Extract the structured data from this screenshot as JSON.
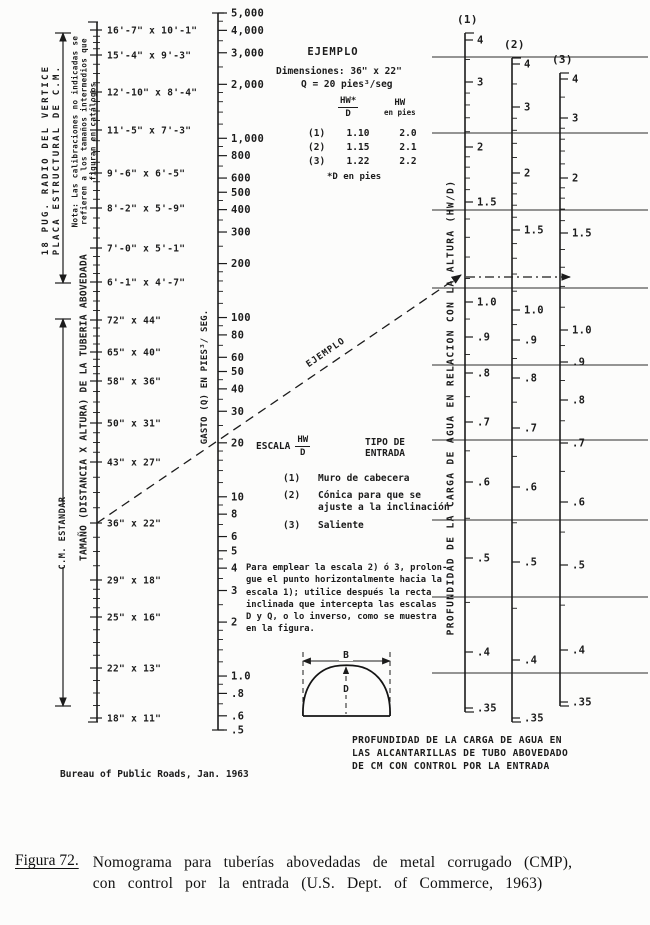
{
  "page": {
    "background": "#fcfcfb",
    "ink": "#1b1b1b"
  },
  "credit": "Bureau of Public Roads, Jan. 1963",
  "caption": {
    "figure_label": "Figura 72.",
    "text": "Nomograma para tuberías abovedadas de metal corrugado (CMP),\ncon control por la entrada (U.S. Dept. of Commerce, 1963)"
  },
  "chart_data": {
    "type": "nomograph",
    "title": "PROFUNDIDAD DE LA CARGA DE AGUA EN\nLAS ALCANTARILLAS DE TUBO ABOVEDADO\nDE CM CON CONTROL POR LA ENTRADA",
    "hw_axis_label": "PROFUNDIDAD DE LA CARGA DE AGUA EN RELACION CON LA ALTURA (HW/D)",
    "grid": {
      "x1": 432,
      "x2": 648,
      "ys": [
        57,
        133,
        210,
        288,
        365,
        440,
        520,
        597,
        673
      ]
    },
    "size_scale": {
      "label": "TAMAÑO (DISTANCIA X ALTURA) DE LA TUBERIA ABOVEDADA",
      "note": "Nota: Las calibraciones no indicadas se\nrefieren a los tamaños intermedios que\nfiguran en catálogos",
      "axis": {
        "x": 97,
        "top": 22,
        "bottom": 722
      },
      "groups": [
        {
          "label": "18 PUG. RADIO DEL VERTICE\nPLACA ESTRUCTURAL DE C.M."
        },
        {
          "label": "C.M. ESTANDAR"
        }
      ],
      "range_arrows": [
        {
          "x": 63,
          "y1": 33,
          "y2": 283,
          "start_arrow": true,
          "end_arrow": true,
          "bars": [
            33,
            283
          ]
        },
        {
          "x": 63,
          "y1": 319,
          "y2": 504,
          "start_arrow": true,
          "end_arrow": false,
          "bars": [
            319
          ]
        },
        {
          "x": 63,
          "y1": 567,
          "y2": 706,
          "start_arrow": false,
          "end_arrow": true,
          "bars": [
            706
          ]
        }
      ],
      "ticks": [
        {
          "label": "16'-7\" x 10'-1\"",
          "y": 30
        },
        {
          "label": "15'-4\" x 9'-3\"",
          "y": 55
        },
        {
          "label": "12'-10\" x 8'-4\"",
          "y": 92
        },
        {
          "label": "11'-5\" x 7'-3\"",
          "y": 130
        },
        {
          "label": "9'-6\" x 6'-5\"",
          "y": 173
        },
        {
          "label": "8'-2\" x 5'-9\"",
          "y": 208
        },
        {
          "label": "7'-0\" x 5'-1\"",
          "y": 248
        },
        {
          "label": "6'-1\" x 4'-7\"",
          "y": 282
        },
        {
          "label": "72\" x 44\"",
          "y": 320
        },
        {
          "label": "65\" x 40\"",
          "y": 352
        },
        {
          "label": "58\" x 36\"",
          "y": 381
        },
        {
          "label": "50\" x 31\"",
          "y": 423
        },
        {
          "label": "43\" x 27\"",
          "y": 462
        },
        {
          "label": "36\" x 22\"",
          "y": 523
        },
        {
          "label": "29\" x 18\"",
          "y": 580
        },
        {
          "label": "25\" x 16\"",
          "y": 617
        },
        {
          "label": "22\" x 13\"",
          "y": 668
        },
        {
          "label": "18\" x 11\"",
          "y": 718
        }
      ]
    },
    "q_scale": {
      "label": "GASTO (Q) EN PIES³/ SEG.",
      "axis": {
        "x": 218,
        "top": 13,
        "bottom": 730,
        "v_top": 5000,
        "v_bottom": 0.5
      },
      "ticks": [
        {
          "v": 5000,
          "label": "5,000"
        },
        {
          "v": 4000,
          "label": "4,000"
        },
        {
          "v": 3000,
          "label": "3,000"
        },
        {
          "v": 2000,
          "label": "2,000"
        },
        {
          "v": 1000,
          "label": "1,000"
        },
        {
          "v": 800,
          "label": "800"
        },
        {
          "v": 600,
          "label": "600"
        },
        {
          "v": 500,
          "label": "500"
        },
        {
          "v": 400,
          "label": "400"
        },
        {
          "v": 300,
          "label": "300"
        },
        {
          "v": 200,
          "label": "200"
        },
        {
          "v": 100,
          "label": "100"
        },
        {
          "v": 80,
          "label": "80"
        },
        {
          "v": 60,
          "label": "60"
        },
        {
          "v": 50,
          "label": "50"
        },
        {
          "v": 40,
          "label": "40"
        },
        {
          "v": 30,
          "label": "30"
        },
        {
          "v": 20,
          "label": "20"
        },
        {
          "v": 10,
          "label": "10"
        },
        {
          "v": 8,
          "label": "8"
        },
        {
          "v": 6,
          "label": "6"
        },
        {
          "v": 5,
          "label": "5"
        },
        {
          "v": 4,
          "label": "4"
        },
        {
          "v": 3,
          "label": "3"
        },
        {
          "v": 2,
          "label": "2"
        },
        {
          "v": 1,
          "label": "1.0"
        },
        {
          "v": 0.8,
          "label": ".8"
        },
        {
          "v": 0.6,
          "label": ".6"
        },
        {
          "v": 0.5,
          "label": ".5"
        }
      ],
      "minor_ticks": [
        0.7,
        0.9,
        1.2,
        1.4,
        1.6,
        1.8,
        2.5,
        3.5,
        4.5,
        7,
        9,
        12,
        14,
        16,
        18,
        25,
        35,
        45,
        70,
        90,
        120,
        140,
        160,
        180,
        250,
        350,
        450,
        700,
        900,
        1200,
        1400,
        1600,
        1800,
        2500,
        3500,
        4500
      ]
    },
    "hw_scales": [
      {
        "name": "(1)",
        "x": 465,
        "top": 33,
        "bottom": 712,
        "ticks": [
          {
            "v": 4,
            "label": "4",
            "y": 40
          },
          {
            "v": 3,
            "label": "3",
            "y": 82
          },
          {
            "v": 2,
            "label": "2",
            "y": 147
          },
          {
            "v": 1.5,
            "label": "1.5",
            "y": 202
          },
          {
            "v": 1,
            "label": "1.0",
            "y": 302
          },
          {
            "v": 0.9,
            "label": ".9",
            "y": 337
          },
          {
            "v": 0.8,
            "label": ".8",
            "y": 373
          },
          {
            "v": 0.7,
            "label": ".7",
            "y": 422
          },
          {
            "v": 0.6,
            "label": ".6",
            "y": 482
          },
          {
            "v": 0.5,
            "label": ".5",
            "y": 558
          },
          {
            "v": 0.4,
            "label": ".4",
            "y": 652
          },
          {
            "v": 0.35,
            "label": ".35",
            "y": 708
          }
        ]
      },
      {
        "name": "(2)",
        "x": 512,
        "top": 58,
        "bottom": 722,
        "ticks": [
          {
            "v": 4,
            "label": "4",
            "y": 64
          },
          {
            "v": 3,
            "label": "3",
            "y": 107
          },
          {
            "v": 2,
            "label": "2",
            "y": 173
          },
          {
            "v": 1.5,
            "label": "1.5",
            "y": 230
          },
          {
            "v": 1,
            "label": "1.0",
            "y": 310
          },
          {
            "v": 0.9,
            "label": ".9",
            "y": 340
          },
          {
            "v": 0.8,
            "label": ".8",
            "y": 378
          },
          {
            "v": 0.7,
            "label": ".7",
            "y": 428
          },
          {
            "v": 0.6,
            "label": ".6",
            "y": 487
          },
          {
            "v": 0.5,
            "label": ".5",
            "y": 562
          },
          {
            "v": 0.4,
            "label": ".4",
            "y": 660
          },
          {
            "v": 0.35,
            "label": ".35",
            "y": 718
          }
        ]
      },
      {
        "name": "(3)",
        "x": 560,
        "top": 73,
        "bottom": 706,
        "ticks": [
          {
            "v": 4,
            "label": "4",
            "y": 79
          },
          {
            "v": 3,
            "label": "3",
            "y": 118
          },
          {
            "v": 2,
            "label": "2",
            "y": 178
          },
          {
            "v": 1.5,
            "label": "1.5",
            "y": 233
          },
          {
            "v": 1,
            "label": "1.0",
            "y": 330
          },
          {
            "v": 0.9,
            "label": ".9",
            "y": 362
          },
          {
            "v": 0.8,
            "label": ".8",
            "y": 400
          },
          {
            "v": 0.7,
            "label": ".7",
            "y": 443
          },
          {
            "v": 0.6,
            "label": ".6",
            "y": 502
          },
          {
            "v": 0.5,
            "label": ".5",
            "y": 565
          },
          {
            "v": 0.4,
            "label": ".4",
            "y": 650
          },
          {
            "v": 0.35,
            "label": ".35",
            "y": 702
          }
        ]
      }
    ],
    "hw_minor_values": [
      3.5,
      2.8,
      2.6,
      2.4,
      2.2,
      1.9,
      1.8,
      1.7,
      1.6,
      1.4,
      1.3,
      1.2,
      1.1,
      0.95,
      0.85,
      0.75,
      0.65,
      0.55,
      0.45
    ],
    "example": {
      "title": "EJEMPLO",
      "dimensions": "Dimensiones: 36\" x 22\"",
      "discharge": "Q = 20 pies³/seg",
      "col1_top": "HW*",
      "col1_bottom": "D",
      "col2_top": "HW",
      "col2_bottom": "en pies",
      "rows": [
        {
          "num": "(1)",
          "hwd": "1.10",
          "hw": "2.0"
        },
        {
          "num": "(2)",
          "hwd": "1.15",
          "hw": "2.1"
        },
        {
          "num": "(3)",
          "hwd": "1.22",
          "hw": "2.2"
        }
      ],
      "footnote": "*D en pies"
    },
    "example_line": {
      "label": "EJEMPLO",
      "x1": 97,
      "y1": 523,
      "x2": 461,
      "y2": 275
    },
    "example_projection": {
      "x1": 466,
      "y1": 277,
      "x2": 570,
      "y2": 277
    },
    "entrance": {
      "scale_word": "ESCALA",
      "frac_top": "HW",
      "frac_bottom": "D",
      "type_header": "TIPO DE\nENTRADA",
      "rows": [
        {
          "num": "(1)",
          "label": "Muro de cabecera"
        },
        {
          "num": "(2)",
          "label": "Cónica para que se\najuste a la inclinación"
        },
        {
          "num": "(3)",
          "label": "Saliente"
        }
      ]
    },
    "instructions": "Para emplear la escala 2) ó 3, prolon-\ngue el punto horizontalmente hacia la\nescala 1); utilice después la recta\ninclinada que intercepta las escalas\nD y Q, o lo inverso, como se muestra\nen la figura.",
    "pipe_arch": {
      "span_label": "B",
      "rise_label": "D"
    }
  }
}
